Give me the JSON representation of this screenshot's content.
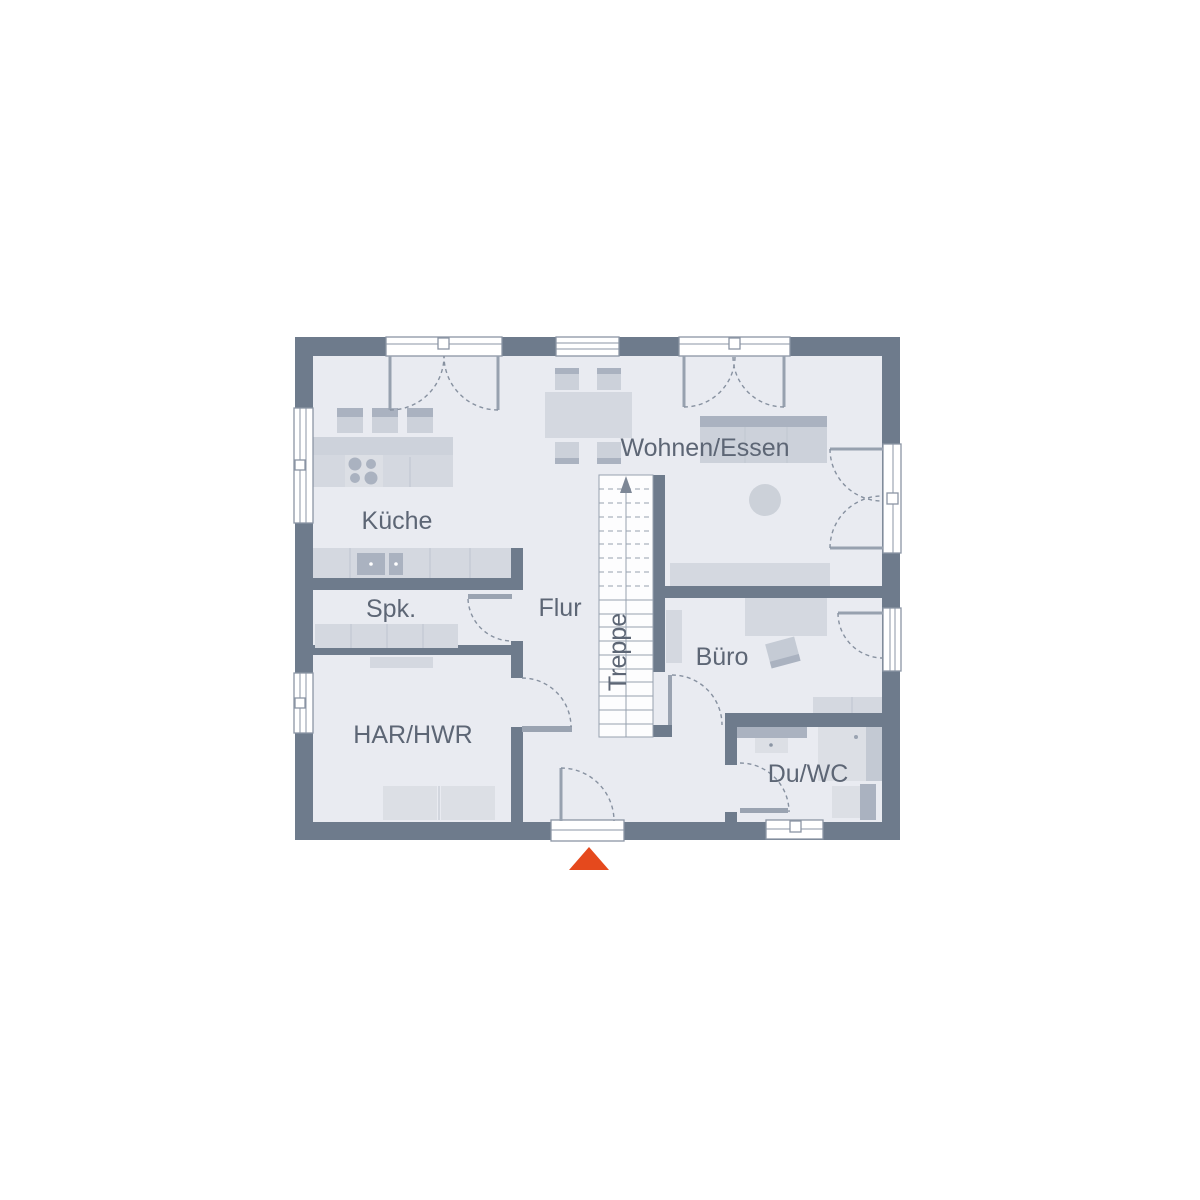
{
  "plan": {
    "title": "Erdgeschoss Grundriss",
    "rooms": [
      {
        "id": "kueche",
        "label": "Küche"
      },
      {
        "id": "wohnen-essen",
        "label": "Wohnen/Essen"
      },
      {
        "id": "spk",
        "label": "Spk."
      },
      {
        "id": "flur",
        "label": "Flur"
      },
      {
        "id": "treppe",
        "label": "Treppe"
      },
      {
        "id": "buero",
        "label": "Büro"
      },
      {
        "id": "har-hwr",
        "label": "HAR/HWR"
      },
      {
        "id": "du-wc",
        "label": "Du/WC"
      }
    ],
    "entrance_marker": {
      "shape": "triangle-up",
      "color": "#e5491d"
    },
    "colors": {
      "wall": "#6e7b8c",
      "floor": "#e9ebf1",
      "furniture": "#d4d8e0",
      "furniture_accent": "#aab2c0",
      "label_text": "#5d6675"
    }
  }
}
